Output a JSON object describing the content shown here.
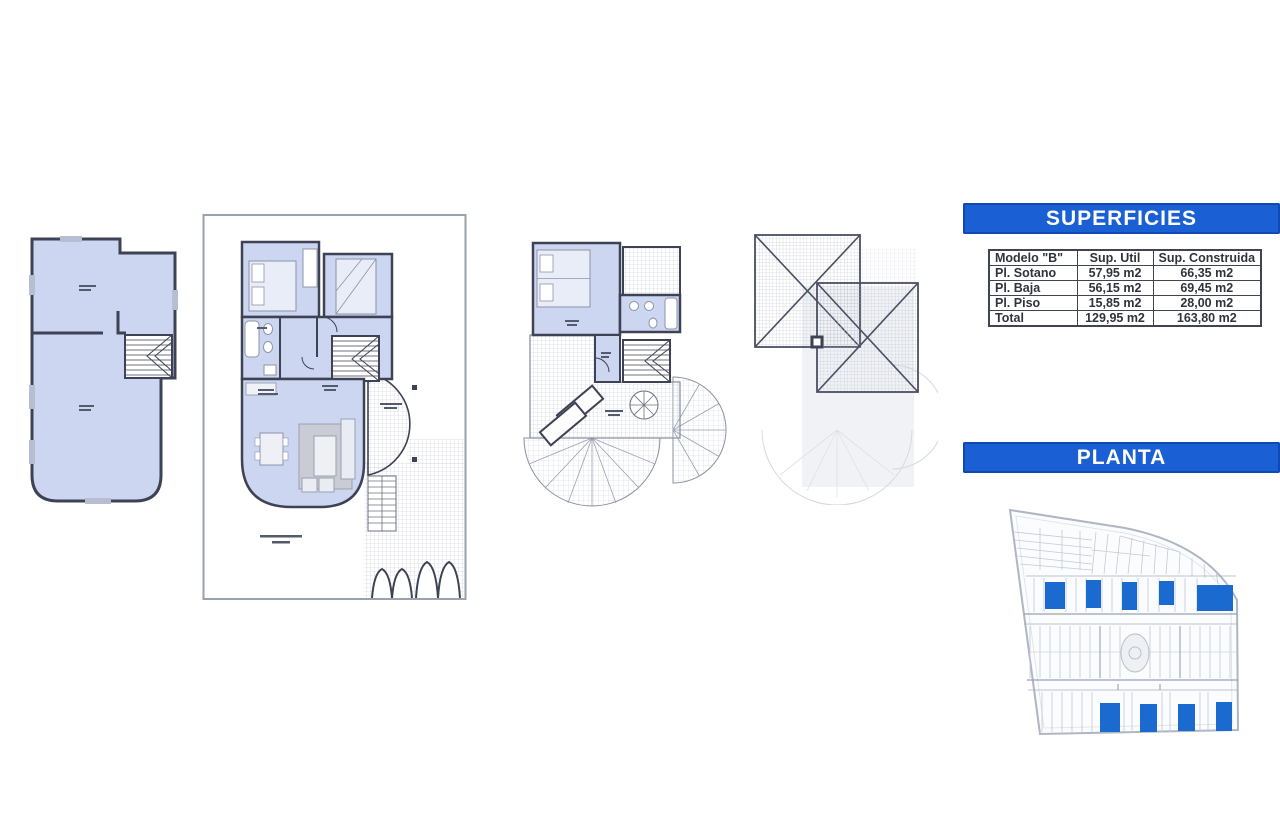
{
  "superficies": {
    "title": "SUPERFICIES",
    "table": {
      "header": [
        "Modelo \"B\"",
        "Sup. Util",
        "Sup. Construida"
      ],
      "rows": [
        [
          "Pl. Sotano",
          "57,95 m2",
          "66,35 m2"
        ],
        [
          "Pl. Baja",
          "56,15 m2",
          "69,45 m2"
        ],
        [
          "Pl. Piso",
          "15,85 m2",
          "28,00 m2"
        ],
        [
          "Total",
          "129,95 m2",
          "163,80 m2"
        ]
      ]
    }
  },
  "planta": {
    "title": "PLANTA"
  },
  "colors": {
    "banner_blue": "#1a5fd3",
    "room_fill_blue": "#ccd6f0",
    "wall_dark": "#3d4254",
    "lot_highlight_blue": "#1b6ad0"
  }
}
